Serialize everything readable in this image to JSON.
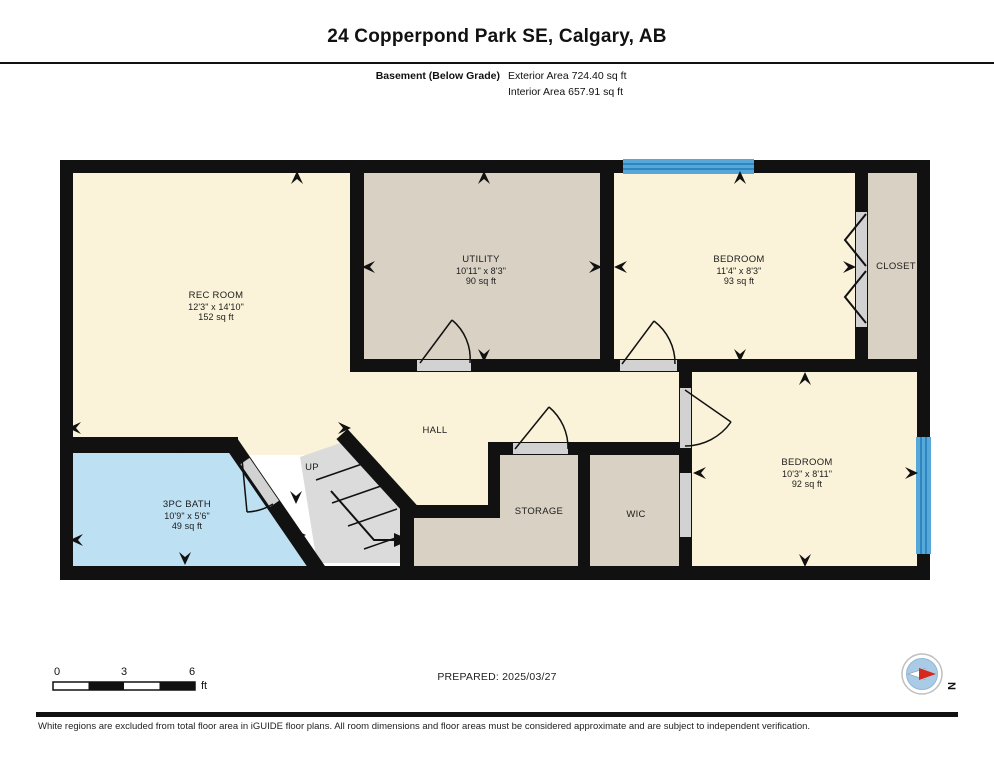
{
  "header": {
    "title": "24 Copperpond Park SE, Calgary, AB",
    "floor_label": "Basement (Below Grade)",
    "exterior_area": "Exterior Area 724.40 sq ft",
    "interior_area": "Interior Area 657.91 sq ft"
  },
  "rooms": [
    {
      "name": "REC ROOM",
      "dims": "12'3\" x 14'10\"",
      "area": "152 sq ft",
      "x": 216,
      "y": 291
    },
    {
      "name": "UTILITY",
      "dims": "10'11\" x 8'3\"",
      "area": "90 sq ft",
      "x": 481,
      "y": 255
    },
    {
      "name": "BEDROOM",
      "dims": "11'4\" x 8'3\"",
      "area": "93 sq ft",
      "x": 739,
      "y": 255
    },
    {
      "name": "CLOSET",
      "dims": "",
      "area": "",
      "x": 896,
      "y": 262
    },
    {
      "name": "HALL",
      "dims": "",
      "area": "",
      "x": 435,
      "y": 426
    },
    {
      "name": "UP",
      "dims": "",
      "area": "",
      "x": 312,
      "y": 463
    },
    {
      "name": "3PC BATH",
      "dims": "10'9\" x 5'6\"",
      "area": "49 sq ft",
      "x": 187,
      "y": 500
    },
    {
      "name": "STORAGE",
      "dims": "",
      "area": "",
      "x": 539,
      "y": 507
    },
    {
      "name": "WIC",
      "dims": "",
      "area": "",
      "x": 636,
      "y": 510
    },
    {
      "name": "BEDROOM",
      "dims": "10'3\" x 8'11\"",
      "area": "92 sq ft",
      "x": 807,
      "y": 458
    }
  ],
  "scale_bar": {
    "label_0": "0",
    "label_3": "3",
    "label_6": "6",
    "unit": "ft"
  },
  "prepared": "PREPARED: 2025/03/27",
  "compass": {
    "icon": "compass-north-icon",
    "label": "N"
  },
  "footer": "White regions are excluded from total floor area in iGUIDE floor plans. All room dimensions and floor areas must be considered approximate and are subject to independent verification.",
  "colors": {
    "room_yellow": "#FAF3D9",
    "room_tan": "#D9D1C4",
    "bath_blue": "#BDE0F2",
    "window_blue": "#56A8D8",
    "window_stripe": "#2E86C1",
    "wall_black": "#111111",
    "stairs_gray": "#DBDBDB",
    "door_gap_gray": "#D2D2D2"
  }
}
